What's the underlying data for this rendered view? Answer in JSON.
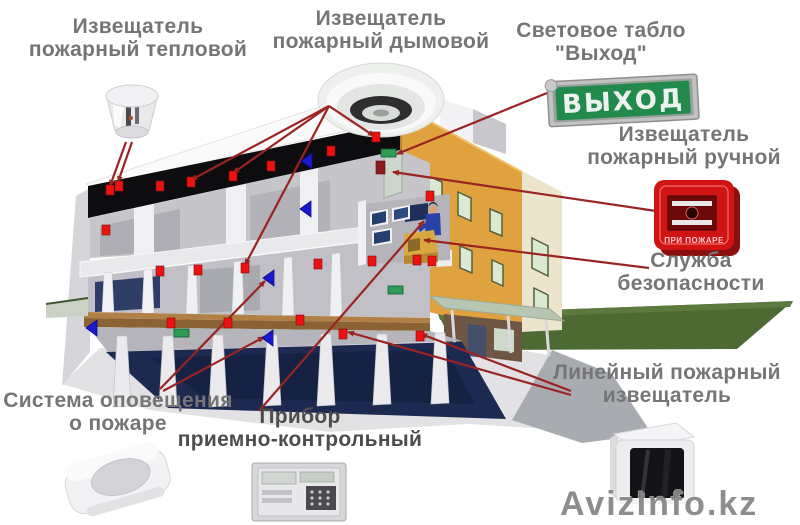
{
  "labels": {
    "heat": {
      "line1": "Извещатель",
      "line2": "пожарный тепловой"
    },
    "smoke": {
      "line1": "Извещатель",
      "line2": "пожарный дымовой"
    },
    "exit_sign": {
      "line1": "Световое табло",
      "line2": "\"Выход\""
    },
    "manual": {
      "line1": "Извещатель",
      "line2": "пожарный ручной"
    },
    "security": {
      "line1": "Служба",
      "line2": "безопасности"
    },
    "linear": {
      "line1": "Линейный пожарный",
      "line2": "извещатель"
    },
    "notification": {
      "line1": "Система оповещения",
      "line2": "о пожаре"
    },
    "panel": {
      "line1": "Прибор",
      "line2": "приемно-контрольный"
    }
  },
  "devices": {
    "exit_sign_board_text": "ВЫХОД",
    "manual_call_point_text": "ПРИ ПОЖАРЕ"
  },
  "watermark": {
    "text": "AvizInfo.kz"
  },
  "colors": {
    "annotation_line": "#9b2423",
    "detector_square": "#ee1111",
    "speaker_blue": "#1a1acc",
    "exit_green": "#2f9c55",
    "wall_call_point": "#8b1a1a",
    "building_orange": "#dfa23e",
    "lawn_green": "#4d6a33",
    "exit_board_green": "#238a4d",
    "call_point_red": "#d01414"
  },
  "markers": {
    "annotation_lines": [
      [
        126,
        142,
        110,
        186
      ],
      [
        132,
        142,
        118,
        182
      ],
      [
        329,
        106,
        191,
        180
      ],
      [
        329,
        106,
        233,
        173
      ],
      [
        329,
        106,
        245,
        265
      ],
      [
        329,
        106,
        374,
        136
      ],
      [
        547,
        93,
        397,
        154
      ],
      [
        656,
        211,
        393,
        172
      ],
      [
        649,
        268,
        424,
        240
      ],
      [
        571,
        391,
        421,
        334
      ],
      [
        571,
        395,
        348,
        332
      ],
      [
        160,
        389,
        265,
        281
      ],
      [
        163,
        391,
        264,
        337
      ],
      [
        259,
        411,
        424,
        221
      ]
    ],
    "fire_detector_points": [
      [
        110,
        190
      ],
      [
        119,
        186
      ],
      [
        160,
        186
      ],
      [
        191,
        182
      ],
      [
        233,
        176
      ],
      [
        271,
        166
      ],
      [
        331,
        151
      ],
      [
        376,
        137
      ],
      [
        106,
        230
      ],
      [
        430,
        196
      ],
      [
        160,
        271
      ],
      [
        198,
        270
      ],
      [
        245,
        268
      ],
      [
        318,
        264
      ],
      [
        372,
        261
      ],
      [
        417,
        260
      ],
      [
        432,
        261
      ],
      [
        171,
        323
      ],
      [
        228,
        323
      ],
      [
        300,
        320
      ],
      [
        343,
        334
      ],
      [
        420,
        336
      ]
    ],
    "speaker_points": [
      [
        301,
        161
      ],
      [
        300,
        209
      ],
      [
        263,
        278
      ],
      [
        262,
        338
      ],
      [
        86,
        328
      ]
    ],
    "exit_sign_points": [
      [
        381,
        149
      ],
      [
        388,
        286
      ],
      [
        174,
        329
      ]
    ],
    "wall_call_point": [
      380,
      167
    ]
  }
}
